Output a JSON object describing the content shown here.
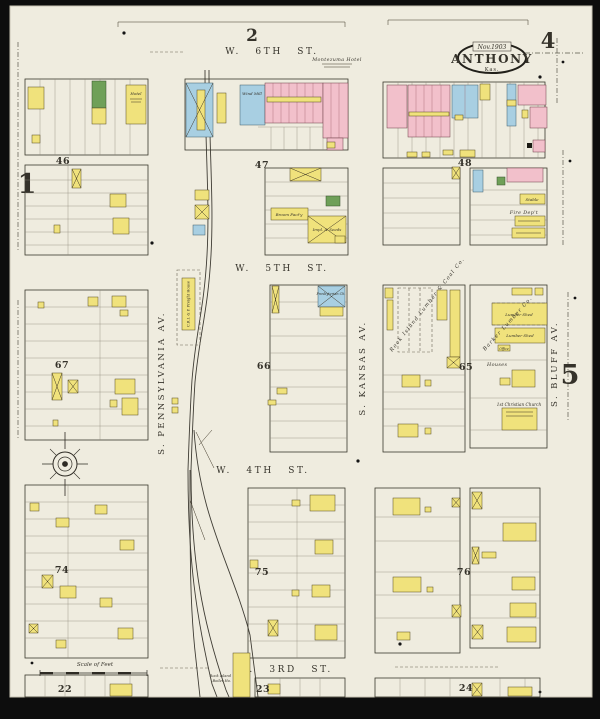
{
  "page": {
    "adjacent_top": "2",
    "adjacent_left": "1",
    "adjacent_right": "5",
    "page_number": "4",
    "stamp": {
      "date": "Nov.1903",
      "city": "ANTHONY",
      "state": "Kas."
    }
  },
  "streets": {
    "w6th": "W. 6TH ST.",
    "w5th": "W. 5TH ST.",
    "w4th": "W. 4TH ST.",
    "w3rd": "W. 3RD ST.",
    "pennsylvania": "S. PENNSYLVANIA AV.",
    "kansas": "S. KANSAS AV.",
    "bluff": "S. BLUFF AV."
  },
  "blocks": {
    "b46": "46",
    "b47": "47",
    "b48": "48",
    "b65": "65",
    "b66": "66",
    "b67": "67",
    "b74": "74",
    "b75": "75",
    "b76": "76",
    "b22": "22",
    "b23": "23",
    "b24": "24"
  },
  "labels": {
    "montezuma_hotel": "Montezuma Hotel",
    "hotel": "Hotel",
    "wind_mill": "Wind Mill",
    "freight_house": "C.R.I. & P. Freight House",
    "broom_factory": "Broom Fact'y",
    "implements": "Impl. & Seeds",
    "fire_dept": "Fire Dep't",
    "stable": "Stable",
    "presbyterian_church": "Presbyterian Ch.",
    "rock_island_lumber": "Rock Island Lumber & Coal Co.",
    "barker_lumber": "Barker Lumber Co.",
    "lumber_shed": "Lumber Shed",
    "office": "Office",
    "houses": "Houses",
    "christian_church": "1st Christian Church",
    "boiler_house_line1": "Rock Island",
    "boiler_house_line2": "Boiler Ho.",
    "scale_of_feet": "Scale of Feet"
  },
  "colors": {
    "paper": "#efecdf",
    "frame": "#0d0d0d",
    "building_wood_yellow": "#f0e27c",
    "building_brick_pink": "#f2c0cb",
    "building_special_blue": "#a8cfe2",
    "building_fireproof_green": "#6fa058"
  }
}
